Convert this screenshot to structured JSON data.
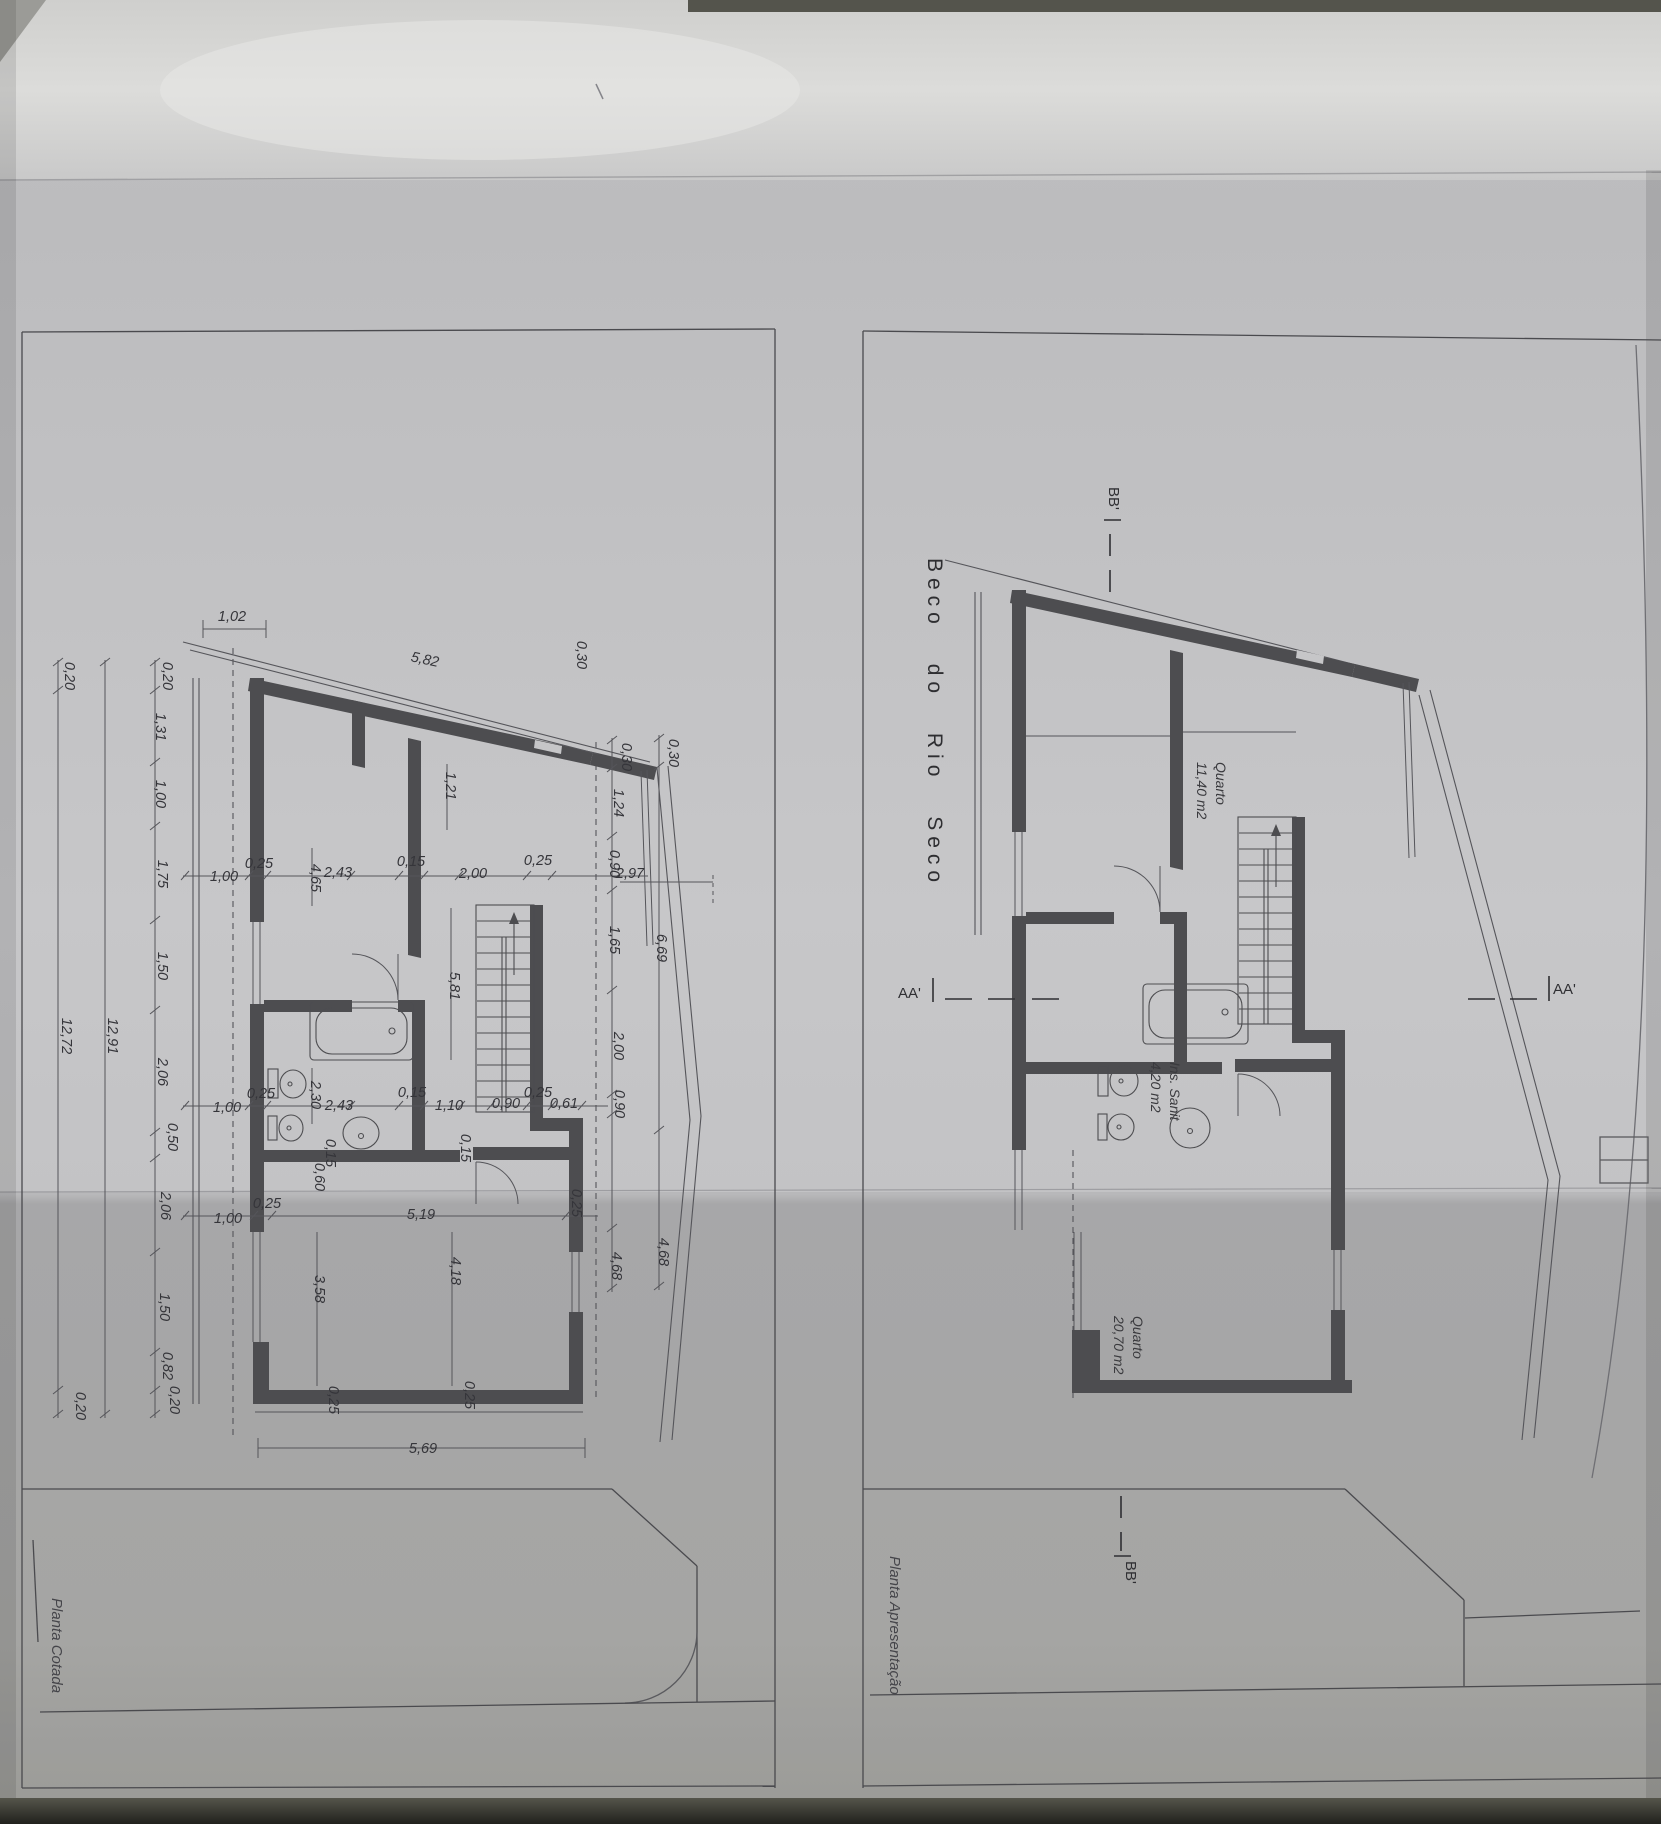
{
  "sheet": {
    "street_title": "Beco do Rio Seco",
    "plans": {
      "cotada": {
        "label": "Planta Cotada"
      },
      "apresentacao": {
        "label": "Planta Apresentação"
      }
    },
    "markers": {
      "aa_left": "AA'",
      "aa_right": "AA'",
      "bb_top": "BB'",
      "bb_bottom": "BB'"
    },
    "rooms": {
      "bedroom_top": {
        "name": "Quarto",
        "area": "11,40 m2"
      },
      "bathroom": {
        "name": "Ins. Sanit",
        "area": "4,20 m2"
      },
      "bedroom_bottom": {
        "name": "Quarto",
        "area": "20,70 m2"
      }
    },
    "colors": {
      "paper": "#c2c2c4",
      "wall_fill": "#4d4d50",
      "line": "#44444a",
      "text": "#35353a"
    },
    "left_plan_dimensions": [
      {
        "v": "1,02",
        "x": 232,
        "y": 621,
        "r": 0
      },
      {
        "v": "5,82",
        "x": 424,
        "y": 664,
        "r": 12
      },
      {
        "v": "0,20",
        "x": 163,
        "y": 676,
        "r": 90
      },
      {
        "v": "1,31",
        "x": 156,
        "y": 727,
        "r": 90
      },
      {
        "v": "1,00",
        "x": 156,
        "y": 794,
        "r": 90
      },
      {
        "v": "1,75",
        "x": 158,
        "y": 874,
        "r": 90
      },
      {
        "v": "1,50",
        "x": 158,
        "y": 966,
        "r": 90
      },
      {
        "v": "2,06",
        "x": 158,
        "y": 1072,
        "r": 90
      },
      {
        "v": "0,50",
        "x": 168,
        "y": 1137,
        "r": 90
      },
      {
        "v": "2,06",
        "x": 161,
        "y": 1206,
        "r": 90
      },
      {
        "v": "1,50",
        "x": 160,
        "y": 1307,
        "r": 90
      },
      {
        "v": "0,82",
        "x": 163,
        "y": 1366,
        "r": 90
      },
      {
        "v": "0,20",
        "x": 170,
        "y": 1400,
        "r": 90
      },
      {
        "v": "12,91",
        "x": 108,
        "y": 1036,
        "r": 90
      },
      {
        "v": "0,20",
        "x": 65,
        "y": 676,
        "r": 90
      },
      {
        "v": "12,72",
        "x": 62,
        "y": 1036,
        "r": 90
      },
      {
        "v": "0,20",
        "x": 76,
        "y": 1406,
        "r": 90
      },
      {
        "v": "1,00",
        "x": 224,
        "y": 881,
        "r": 0
      },
      {
        "v": "0,25",
        "x": 259,
        "y": 868,
        "r": 0
      },
      {
        "v": "4,65",
        "x": 311,
        "y": 878,
        "r": 90
      },
      {
        "v": "2,43",
        "x": 338,
        "y": 877,
        "r": 0
      },
      {
        "v": "0,15",
        "x": 411,
        "y": 866,
        "r": 0
      },
      {
        "v": "2,00",
        "x": 473,
        "y": 878,
        "r": 0
      },
      {
        "v": "0,25",
        "x": 538,
        "y": 865,
        "r": 0
      },
      {
        "v": "2,97",
        "x": 630,
        "y": 878,
        "r": 0
      },
      {
        "v": "0,30",
        "x": 577,
        "y": 655,
        "r": 90
      },
      {
        "v": "0,30",
        "x": 622,
        "y": 757,
        "r": 90
      },
      {
        "v": "0,30",
        "x": 669,
        "y": 753,
        "r": 90
      },
      {
        "v": "1,24",
        "x": 614,
        "y": 803,
        "r": 90
      },
      {
        "v": "0,90",
        "x": 610,
        "y": 864,
        "r": 90
      },
      {
        "v": "1,65",
        "x": 610,
        "y": 940,
        "r": 90
      },
      {
        "v": "6,69",
        "x": 657,
        "y": 948,
        "r": 90
      },
      {
        "v": "2,00",
        "x": 614,
        "y": 1046,
        "r": 90
      },
      {
        "v": "0,90",
        "x": 615,
        "y": 1104,
        "r": 90
      },
      {
        "v": "4,68",
        "x": 612,
        "y": 1266,
        "r": 90
      },
      {
        "v": "4,68",
        "x": 659,
        "y": 1252,
        "r": 90
      },
      {
        "v": "1,21",
        "x": 446,
        "y": 786,
        "r": 90
      },
      {
        "v": "5,81",
        "x": 450,
        "y": 986,
        "r": 90
      },
      {
        "v": "1,00",
        "x": 227,
        "y": 1112,
        "r": 0
      },
      {
        "v": "0,25",
        "x": 261,
        "y": 1098,
        "r": 0
      },
      {
        "v": "2,30",
        "x": 311,
        "y": 1095,
        "r": 90
      },
      {
        "v": "2,43",
        "x": 339,
        "y": 1110,
        "r": 0
      },
      {
        "v": "0,15",
        "x": 412,
        "y": 1097,
        "r": 0
      },
      {
        "v": "1,10",
        "x": 449,
        "y": 1110,
        "r": 0
      },
      {
        "v": "0,90",
        "x": 506,
        "y": 1108,
        "r": 0
      },
      {
        "v": "0,25",
        "x": 538,
        "y": 1097,
        "r": 0
      },
      {
        "v": "0,61",
        "x": 564,
        "y": 1108,
        "r": 0
      },
      {
        "v": "0,15",
        "x": 326,
        "y": 1153,
        "r": 90
      },
      {
        "v": "0,60",
        "x": 315,
        "y": 1177,
        "r": 90
      },
      {
        "v": "0,15",
        "x": 461,
        "y": 1148,
        "r": 90
      },
      {
        "v": "1,00",
        "x": 228,
        "y": 1223,
        "r": 0
      },
      {
        "v": "0,25",
        "x": 267,
        "y": 1208,
        "r": 0
      },
      {
        "v": "5,19",
        "x": 421,
        "y": 1219,
        "r": 0
      },
      {
        "v": "0,25",
        "x": 572,
        "y": 1203,
        "r": 90
      },
      {
        "v": "3,58",
        "x": 315,
        "y": 1289,
        "r": 90
      },
      {
        "v": "4,18",
        "x": 451,
        "y": 1271,
        "r": 90
      },
      {
        "v": "0,25",
        "x": 329,
        "y": 1400,
        "r": 90
      },
      {
        "v": "0,25",
        "x": 465,
        "y": 1395,
        "r": 90
      },
      {
        "v": "5,69",
        "x": 423,
        "y": 1453,
        "r": 0
      }
    ]
  }
}
